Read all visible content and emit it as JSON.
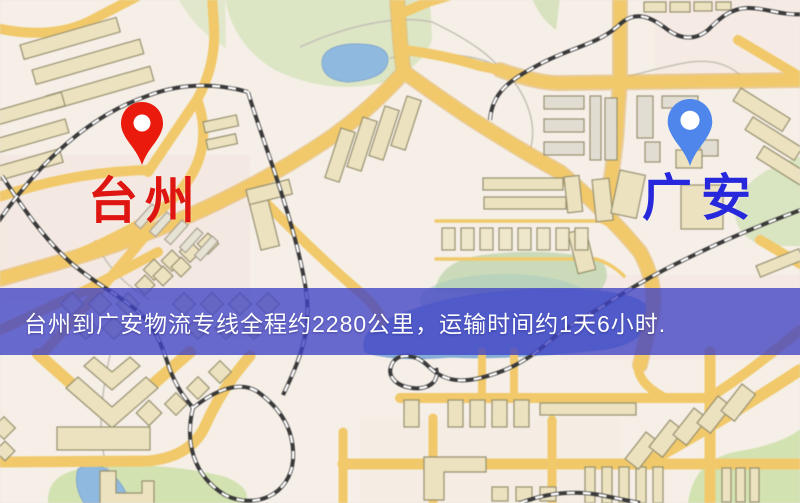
{
  "map": {
    "markers": {
      "origin": {
        "label": "台州",
        "pin_color": "#ea1a0c",
        "label_color": "#de1510"
      },
      "destination": {
        "label": "广安",
        "pin_color": "#4f86ec",
        "label_color": "#2727dc"
      }
    },
    "banner": {
      "text": "台州到广安物流专线全程约2280公里，运输时间约1天6小时.",
      "background": "rgba(64,67,196,0.78)",
      "text_color": "#ffffff"
    },
    "colors": {
      "map_background": "#f5efe7",
      "road": "#f2c967",
      "road_casing": "#e2ae54",
      "park": "#dce5c3",
      "water": "#8fb9e0",
      "railway": "#333333",
      "building": "#ece2bf"
    }
  }
}
